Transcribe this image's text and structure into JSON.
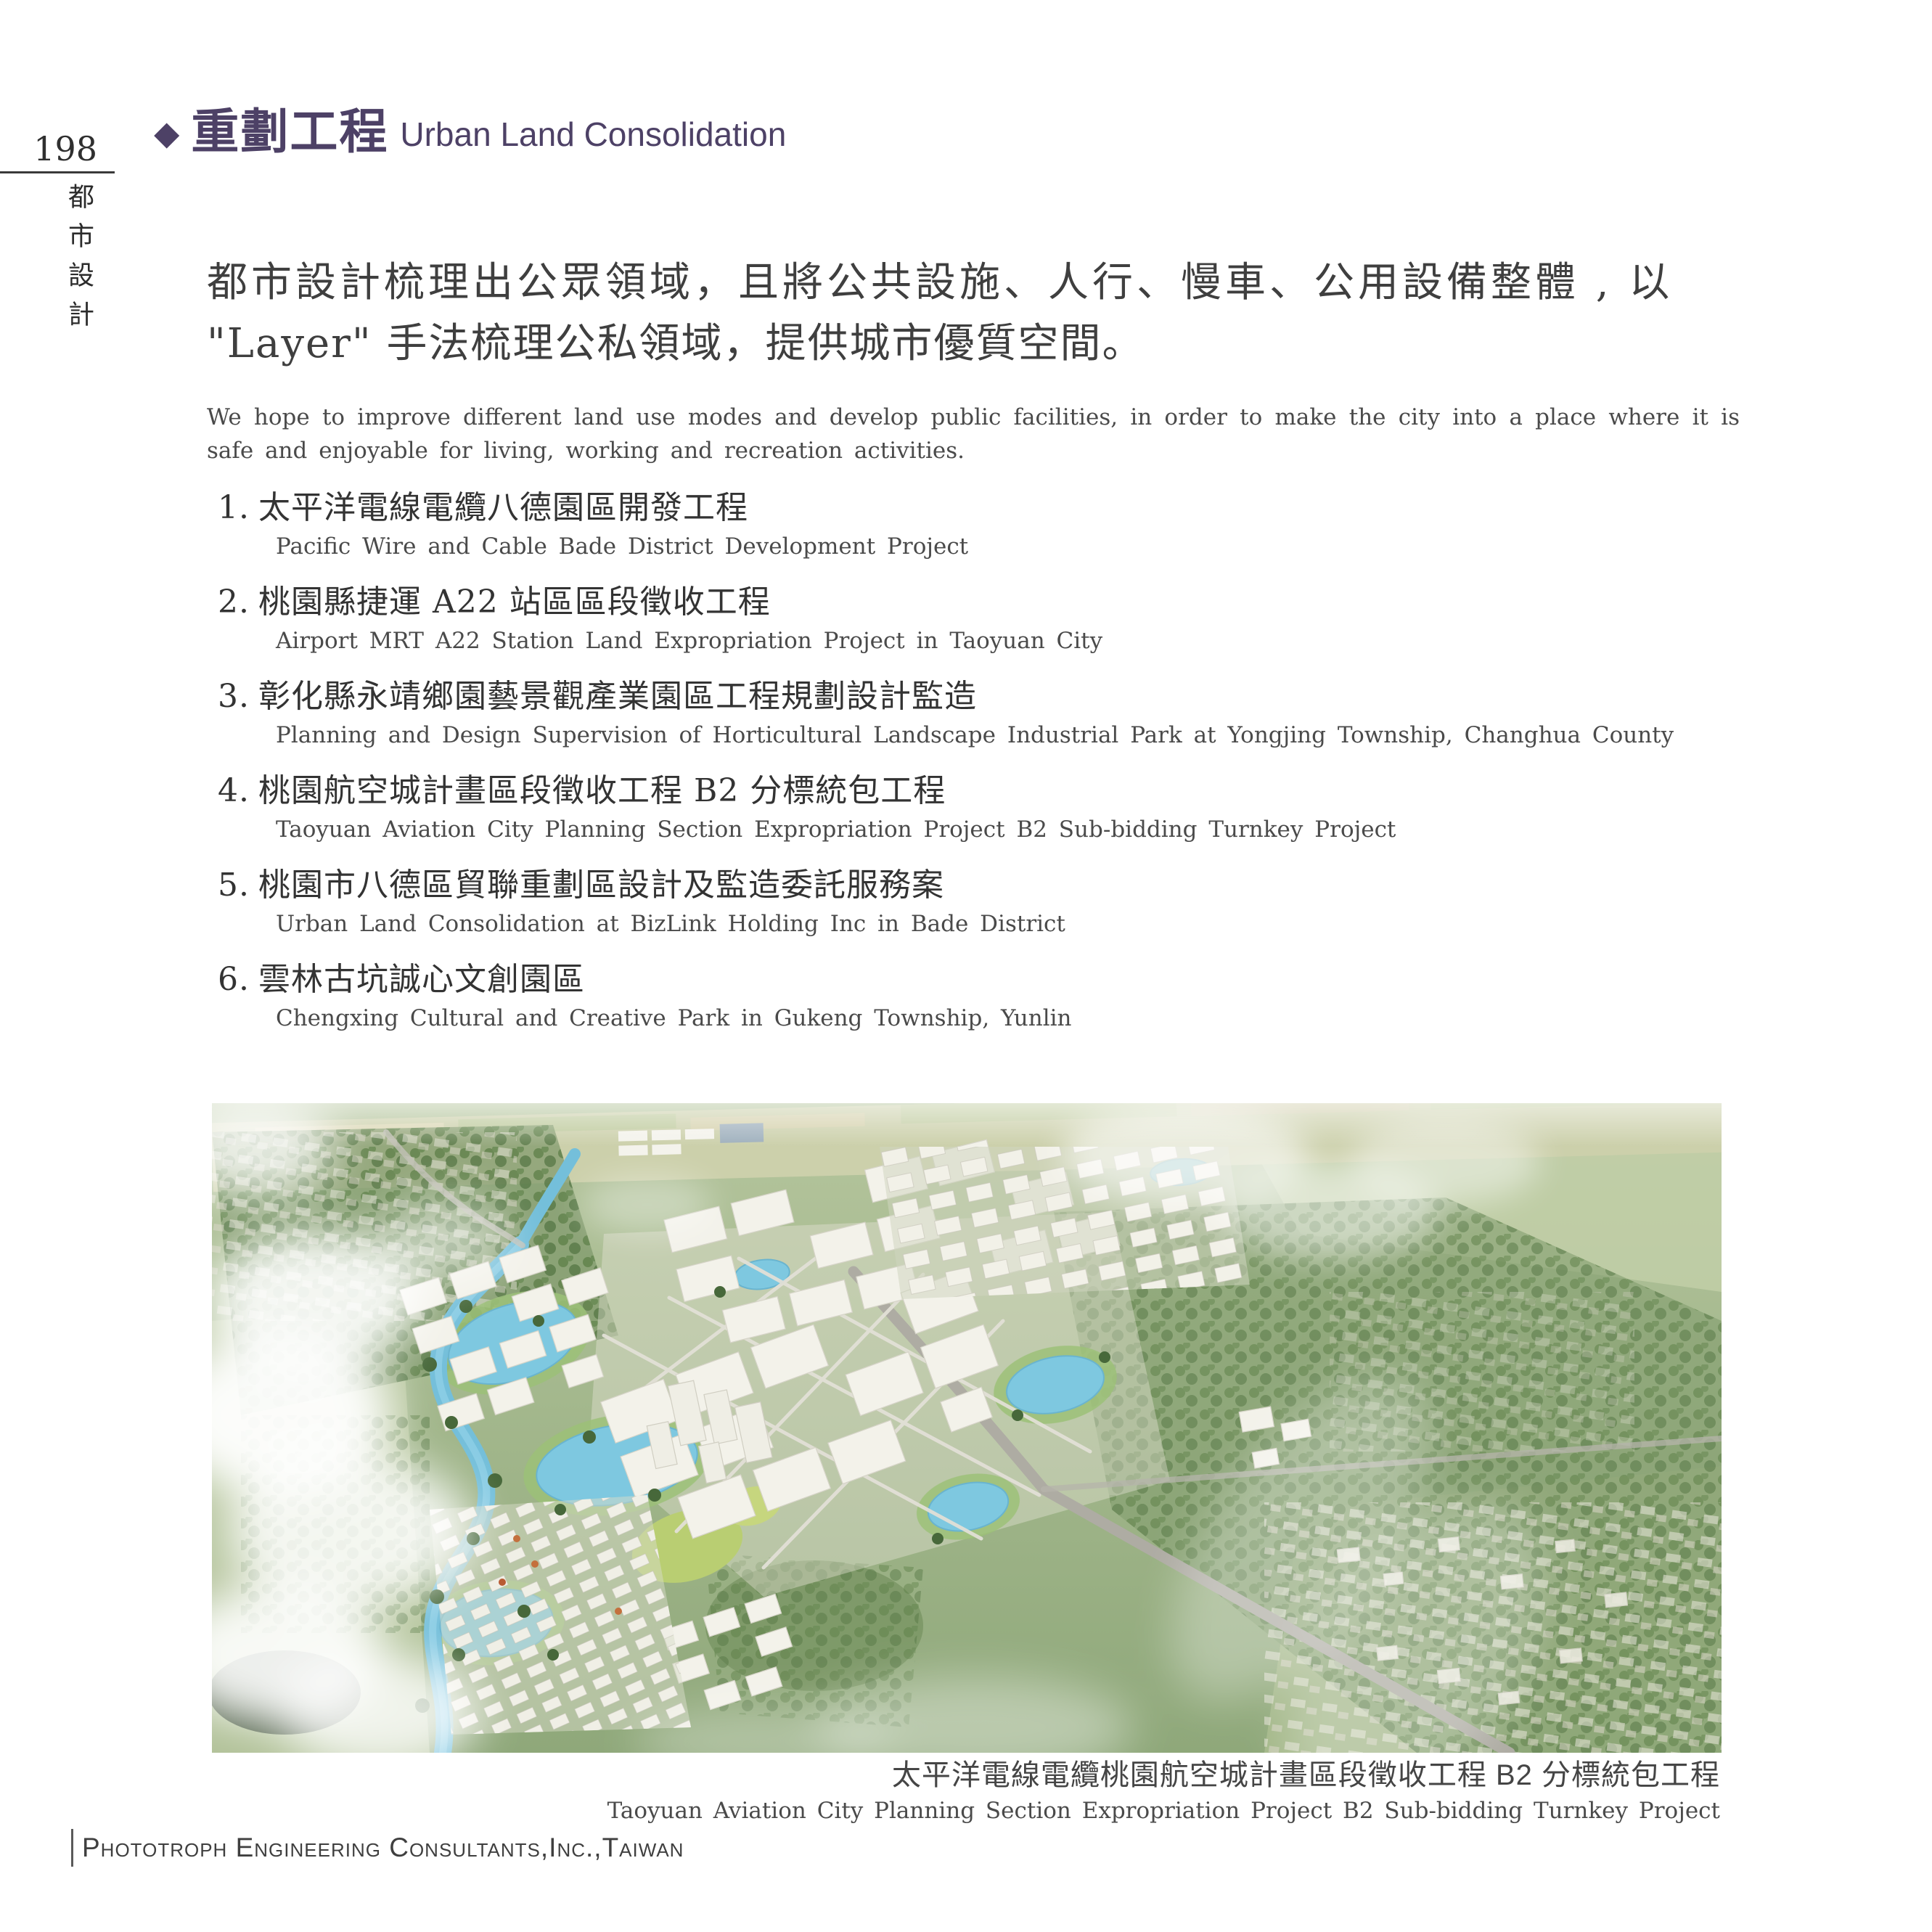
{
  "page": {
    "number": "198",
    "side_label": "都市設計",
    "footer_company": "Phototroph Engineering Consultants,Inc.,Taiwan"
  },
  "header": {
    "diamond_icon": "◆",
    "title_zh": "重劃工程",
    "title_en": "Urban Land Consolidation",
    "accent_color": "#4d4166"
  },
  "intro": {
    "heading_zh_line1": "都市設計梳理出公眾領域，且將公共設施、人行、慢車、公用設備整體 , 以",
    "heading_zh_line2": "\"Layer\" 手法梳理公私領域，提供城市優質空間。",
    "body_en": "We hope to improve different land use modes and develop public facilities, in order to make the city into a place where it is safe and enjoyable for living, working and recreation activities."
  },
  "projects": [
    {
      "num": "1.",
      "zh": "太平洋電線電纜八德園區開發工程",
      "en": "Pacific Wire and Cable Bade District Development Project"
    },
    {
      "num": "2.",
      "zh": "桃園縣捷運 A22 站區區段徵收工程",
      "en": "Airport MRT A22 Station Land Expropriation Project in Taoyuan City"
    },
    {
      "num": "3.",
      "zh": "彰化縣永靖鄉園藝景觀產業園區工程規劃設計監造",
      "en": "Planning and Design Supervision of Horticultural Landscape Industrial Park at Yongjing Township, Changhua County"
    },
    {
      "num": "4.",
      "zh": "桃園航空城計畫區段徵收工程 B2 分標統包工程",
      "en": "Taoyuan Aviation City Planning Section Expropriation Project B2 Sub-bidding Turnkey Project"
    },
    {
      "num": "5.",
      "zh": "桃園市八德區貿聯重劃區設計及監造委託服務案",
      "en": "Urban Land Consolidation at BizLink Holding Inc in Bade District"
    },
    {
      "num": "6.",
      "zh": "雲林古坑誠心文創園區",
      "en": "Chengxing Cultural and Creative Park in Gukeng Township, Yunlin"
    }
  ],
  "figure": {
    "caption_zh": "太平洋電線電纜桃園航空城計畫區段徵收工程 B2 分標統包工程",
    "caption_en": "Taoyuan Aviation City Planning Section Expropriation Project B2 Sub-bidding Turnkey Project"
  }
}
